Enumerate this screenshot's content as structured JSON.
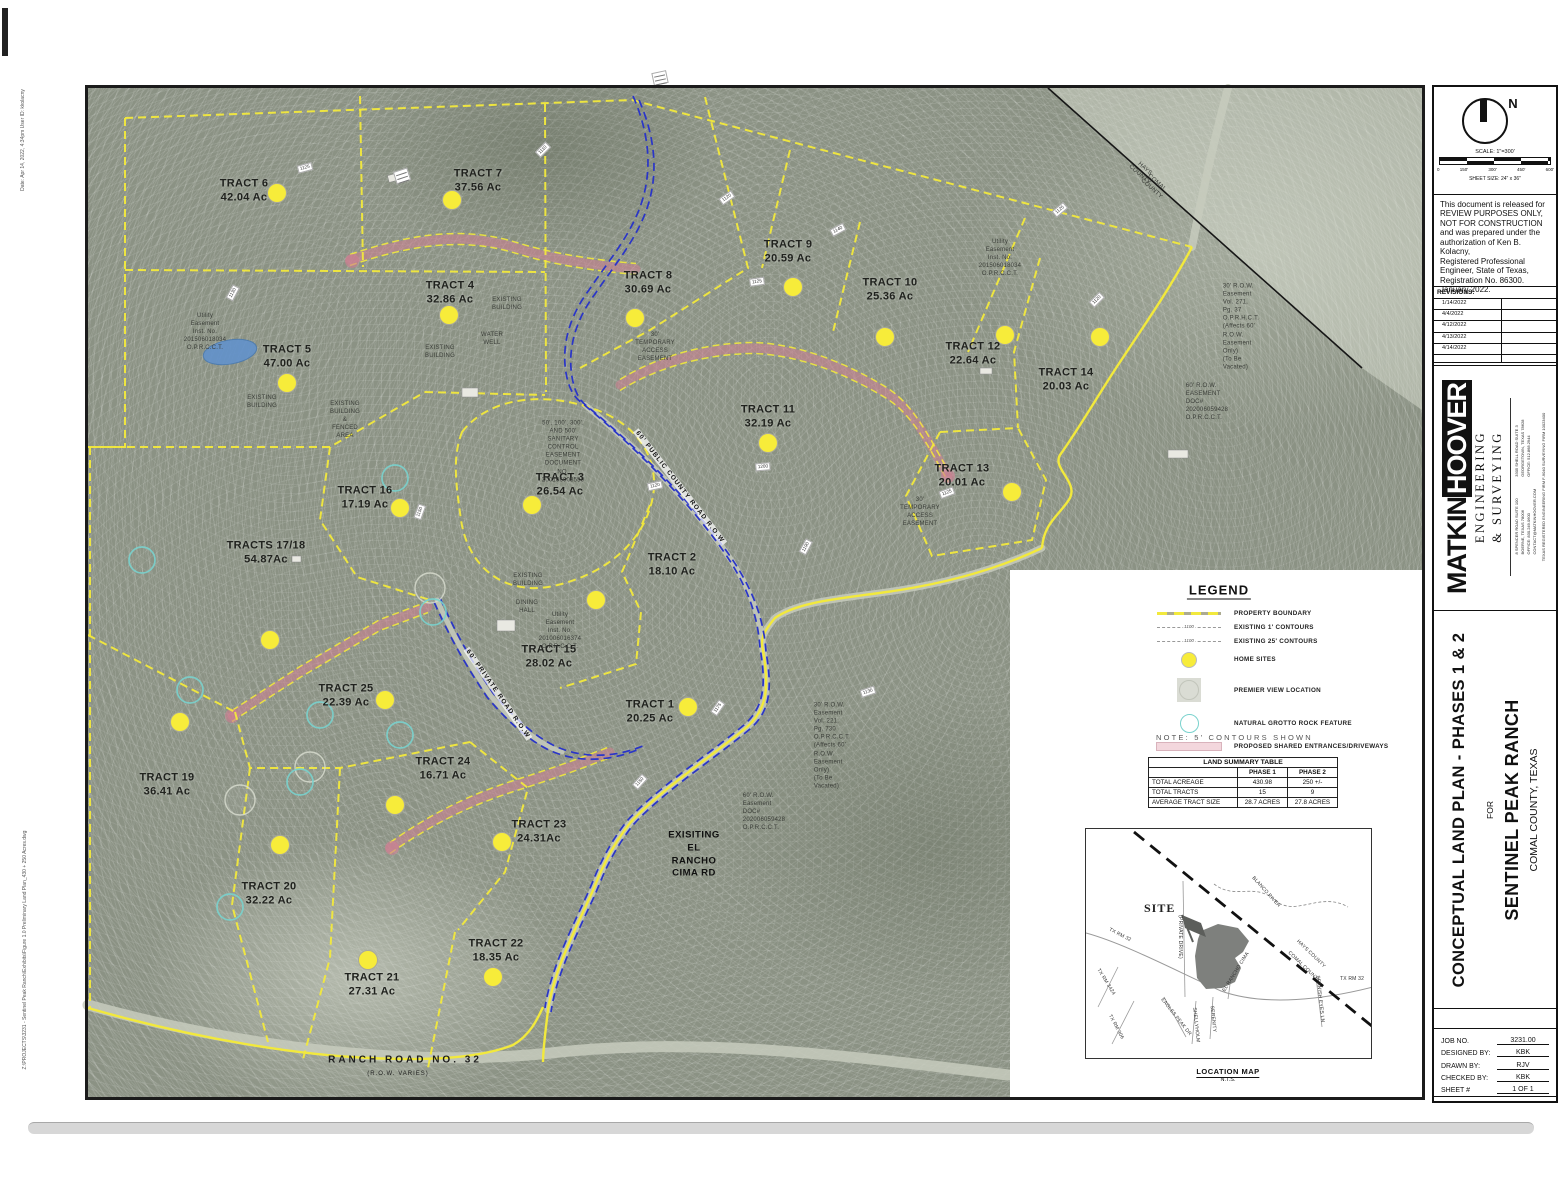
{
  "edge": {
    "date_stamp": "Date: Apr 14, 2022, 4:34pm   User ID: kkolacny",
    "file_path": "Z:\\PROJECTS\\3231 - Sentinel Peak Ranch\\Exhibits\\Figure 1.0 Preliminary Land Plan_430 + 250 Acres.dwg"
  },
  "colors": {
    "boundary_yellow": "#f2e93c",
    "home_site_yellow": "#f7ec3a",
    "road_blue": "#2a35c8",
    "driveway_pink": "#cf7f92",
    "grotto_teal": "#79d2cd",
    "aerial_base": "#8b9284"
  },
  "map": {
    "tracts": [
      {
        "n": "TRACT 6",
        "a": "42.04 Ac",
        "x": 244,
        "y": 191
      },
      {
        "n": "TRACT 7",
        "a": "37.56 Ac",
        "x": 478,
        "y": 181
      },
      {
        "n": "TRACT 4",
        "a": "32.86 Ac",
        "x": 450,
        "y": 293
      },
      {
        "n": "TRACT 5",
        "a": "47.00 Ac",
        "x": 287,
        "y": 357
      },
      {
        "n": "TRACT 8",
        "a": "30.69 Ac",
        "x": 648,
        "y": 283
      },
      {
        "n": "TRACT 9",
        "a": "20.59 Ac",
        "x": 788,
        "y": 252
      },
      {
        "n": "TRACT 10",
        "a": "25.36 Ac",
        "x": 890,
        "y": 290
      },
      {
        "n": "TRACT 12",
        "a": "22.64 Ac",
        "x": 973,
        "y": 354
      },
      {
        "n": "TRACT 14",
        "a": "20.03 Ac",
        "x": 1066,
        "y": 380
      },
      {
        "n": "TRACT 11",
        "a": "32.19 Ac",
        "x": 768,
        "y": 417
      },
      {
        "n": "TRACT 13",
        "a": "20.01 Ac",
        "x": 962,
        "y": 476
      },
      {
        "n": "TRACT 16",
        "a": "17.19 Ac",
        "x": 365,
        "y": 498
      },
      {
        "n": "TRACT 3",
        "a": "26.54 Ac",
        "x": 560,
        "y": 485
      },
      {
        "n": "TRACT 2",
        "a": "18.10 Ac",
        "x": 672,
        "y": 565
      },
      {
        "n": "TRACTS 17/18",
        "a": "54.87Ac",
        "x": 266,
        "y": 553
      },
      {
        "n": "TRACT 15",
        "a": "28.02 Ac",
        "x": 549,
        "y": 657
      },
      {
        "n": "TRACT 25",
        "a": "22.39 Ac",
        "x": 346,
        "y": 696
      },
      {
        "n": "TRACT 19",
        "a": "36.41 Ac",
        "x": 167,
        "y": 785
      },
      {
        "n": "TRACT 24",
        "a": "16.71 Ac",
        "x": 443,
        "y": 769
      },
      {
        "n": "TRACT 1",
        "a": "20.25 Ac",
        "x": 650,
        "y": 712
      },
      {
        "n": "TRACT 23",
        "a": "24.31Ac",
        "x": 539,
        "y": 832
      },
      {
        "n": "TRACT 20",
        "a": "32.22 Ac",
        "x": 269,
        "y": 894
      },
      {
        "n": "TRACT 22",
        "a": "18.35 Ac",
        "x": 496,
        "y": 951
      },
      {
        "n": "TRACT 21",
        "a": "27.31 Ac",
        "x": 372,
        "y": 985
      }
    ],
    "home_sites": [
      [
        277,
        193
      ],
      [
        452,
        200
      ],
      [
        449,
        315
      ],
      [
        287,
        383
      ],
      [
        635,
        318
      ],
      [
        793,
        287
      ],
      [
        885,
        337
      ],
      [
        1005,
        335
      ],
      [
        1100,
        337
      ],
      [
        768,
        443
      ],
      [
        1012,
        492
      ],
      [
        400,
        508
      ],
      [
        532,
        505
      ],
      [
        596,
        600
      ],
      [
        270,
        640
      ],
      [
        385,
        700
      ],
      [
        180,
        722
      ],
      [
        395,
        805
      ],
      [
        688,
        707
      ],
      [
        502,
        842
      ],
      [
        280,
        845
      ],
      [
        493,
        977
      ],
      [
        368,
        960
      ]
    ],
    "grottoes": [
      [
        395,
        478
      ],
      [
        433,
        612
      ],
      [
        400,
        735
      ],
      [
        320,
        715
      ],
      [
        300,
        782
      ],
      [
        230,
        907
      ],
      [
        142,
        560
      ],
      [
        190,
        690
      ]
    ],
    "premier_views": [
      [
        430,
        588
      ],
      [
        240,
        800
      ],
      [
        310,
        767
      ]
    ],
    "elev_tags": [
      {
        "t": "1125",
        "x": 305,
        "y": 168,
        "r": -15
      },
      {
        "t": "1130",
        "x": 233,
        "y": 293,
        "r": -62
      },
      {
        "t": "1110",
        "x": 543,
        "y": 150,
        "r": -45
      },
      {
        "t": "1120",
        "x": 727,
        "y": 198,
        "r": -35
      },
      {
        "t": "1140",
        "x": 838,
        "y": 230,
        "r": -28
      },
      {
        "t": "1125",
        "x": 757,
        "y": 282,
        "r": -8
      },
      {
        "t": "1120",
        "x": 1097,
        "y": 300,
        "r": -45
      },
      {
        "t": "1120",
        "x": 655,
        "y": 486,
        "r": -12
      },
      {
        "t": "1200",
        "x": 763,
        "y": 467,
        "r": -5
      },
      {
        "t": "1150",
        "x": 420,
        "y": 512,
        "r": -70
      },
      {
        "t": "1190",
        "x": 806,
        "y": 547,
        "r": -62
      },
      {
        "t": "1175",
        "x": 718,
        "y": 708,
        "r": -55
      },
      {
        "t": "1150",
        "x": 640,
        "y": 782,
        "r": -48
      },
      {
        "t": "1130",
        "x": 868,
        "y": 692,
        "r": -18
      },
      {
        "t": "1125",
        "x": 947,
        "y": 493,
        "r": -20
      },
      {
        "t": "1125",
        "x": 1060,
        "y": 210,
        "r": -40
      }
    ],
    "stack_tags": [
      [
        402,
        176,
        -18
      ],
      [
        660,
        78,
        -12
      ]
    ],
    "annotations": [
      {
        "t": "Utility Easement\nInst. No. 201506018034\nO.P.R.C.C.T.",
        "x": 205,
        "y": 332
      },
      {
        "t": "EXISTING\nBUILDING",
        "x": 262,
        "y": 402
      },
      {
        "t": "EXISTING BUILDING\n& FENCED AREA",
        "x": 345,
        "y": 420
      },
      {
        "t": "EXISTING\nBUILDING",
        "x": 440,
        "y": 352
      },
      {
        "t": "EXISTING\nBUILDING",
        "x": 507,
        "y": 304
      },
      {
        "t": "WATER WELL",
        "x": 492,
        "y": 339
      },
      {
        "t": "30' TEMPORARY\nACCESS\nEASEMENT",
        "x": 655,
        "y": 347
      },
      {
        "t": "Utility Easement\nInst. No. 201506018034\nO.P.R.C.C.T.",
        "x": 1000,
        "y": 258
      },
      {
        "t": "50', 100', 300', AND 500'\nSANITARY CONTROL EASEMENT\nDOCUMENT NO. 200106008559",
        "x": 563,
        "y": 452
      },
      {
        "t": "EXISTING\nBUILDING",
        "x": 528,
        "y": 580
      },
      {
        "t": "DINING\nHALL",
        "x": 527,
        "y": 607
      },
      {
        "t": "Utility Easement\nInst. No. 201006016374\nO.P.R.C.C.T.",
        "x": 560,
        "y": 631
      },
      {
        "t": "30' R.O.W. Easement\nVol. 271, Pg. 37\nO.P.R.H.C.T.\n(Affects 60' R.O.W. Easement\nOnly)\n(To Be Vacated)",
        "x": 1241,
        "y": 327,
        "cls": "l"
      },
      {
        "t": "60' R.O.W. EASEMENT\nDOC# 202006059428\nO.P.R.C.C.T.",
        "x": 1207,
        "y": 402,
        "cls": "l"
      },
      {
        "t": "30' TEMPORARY\nACCESS\nEASEMENT",
        "x": 920,
        "y": 512
      },
      {
        "t": "30' R.O.W. Easement\nVol. 221, Pg. 730\nO.P.R.C.C.T.\n(Affects 60' R.O.W. Easement\nOnly)\n(To Be Vacated)",
        "x": 832,
        "y": 746,
        "cls": "l"
      },
      {
        "t": "60' R.O.W. Easement\nDOC# 202006059428\nO.P.R.C.C.T.",
        "x": 764,
        "y": 812,
        "cls": "l"
      },
      {
        "t": "EXISITING EL RANCHO\nCIMA RD",
        "x": 694,
        "y": 855,
        "cls": "d"
      },
      {
        "t": "HAYS COUNTY",
        "x": 1142,
        "y": 172,
        "r": 42
      },
      {
        "t": "COMAL COUNTY",
        "x": 1154,
        "y": 186,
        "r": 42
      },
      {
        "t": "RANCH ROAD NO. 32",
        "x": 405,
        "y": 1060,
        "cls": "rr"
      },
      {
        "t": "(R.O.W. VARIES)",
        "x": 398,
        "y": 1074,
        "cls": "rr2"
      }
    ],
    "road_labels": [
      {
        "t": "60' PUBLIC COUNTY ROAD R.O.W",
        "x": 680,
        "y": 487,
        "r": 52
      },
      {
        "t": "60' PRIVATE ROAD R.O.W",
        "x": 498,
        "y": 694,
        "r": 55
      }
    ]
  },
  "legend": {
    "title": "LEGEND",
    "rows": [
      {
        "k": "boundary",
        "label": "PROPERTY BOUNDARY"
      },
      {
        "k": "contour1",
        "label": "EXISTING 1' CONTOURS",
        "tag": "1100"
      },
      {
        "k": "contour25",
        "label": "EXISTING 25' CONTOURS",
        "tag": "1100"
      },
      {
        "k": "home",
        "label": "HOME SITES"
      },
      {
        "k": "premier",
        "label": "PREMIER VIEW LOCATION"
      },
      {
        "k": "grotto",
        "label": "NATURAL GROTTO ROCK FEATURE"
      },
      {
        "k": "driveway",
        "label": "PROPOSED SHARED ENTRANCES/DRIVEWAYS"
      }
    ],
    "note": "NOTE:  5'  CONTOURS  SHOWN"
  },
  "summary": {
    "title": "LAND SUMMARY TABLE",
    "c1": "PHASE 1",
    "c2": "PHASE 2",
    "rows": [
      [
        "TOTAL ACREAGE",
        "430.98",
        "250 +/-"
      ],
      [
        "TOTAL TRACTS",
        "15",
        "9"
      ],
      [
        "AVERAGE TRACT SIZE",
        "28.7 ACRES",
        "27.8 ACRES"
      ]
    ]
  },
  "locmap": {
    "site": "SITE",
    "caption": "LOCATION MAP",
    "nts": "N.T.S.",
    "labels": [
      {
        "t": "TX RM 32",
        "x": 34,
        "y": 106,
        "r": 27
      },
      {
        "t": "TX RM 3424",
        "x": 20,
        "y": 153,
        "r": 58
      },
      {
        "t": "TX RM 306",
        "x": 30,
        "y": 198,
        "r": 62
      },
      {
        "t": "(PRIVATE DRIVE)",
        "x": 94,
        "y": 108,
        "r": 90
      },
      {
        "t": "EAGLES PEAK DR",
        "x": 90,
        "y": 188,
        "r": 52
      },
      {
        "t": "SHELLYHOLM",
        "x": 110,
        "y": 196,
        "r": 84
      },
      {
        "t": "SERENITY",
        "x": 127,
        "y": 190,
        "r": 84
      },
      {
        "t": "EL RANCHO CIMA",
        "x": 150,
        "y": 143,
        "r": -58
      },
      {
        "t": "SPANISH EYES LN",
        "x": 234,
        "y": 170,
        "r": 84
      },
      {
        "t": "BLANCO RIVER",
        "x": 180,
        "y": 63,
        "r": 48
      },
      {
        "t": "HAYS COUNTY",
        "x": 225,
        "y": 125,
        "r": 44
      },
      {
        "t": "COMAL COUNTY",
        "x": 218,
        "y": 138,
        "r": 44
      },
      {
        "t": "TX RM 32",
        "x": 266,
        "y": 150,
        "r": 0
      }
    ]
  },
  "titleblock": {
    "north": "N",
    "scale_label": "SCALE: 1\"=300'",
    "scale_ticks": [
      "0",
      "150'",
      "300'",
      "450'",
      "600'"
    ],
    "sheet_size": "SHEET SIZE: 24\" x 36\"",
    "review_note": "This document is released for\nREVIEW PURPOSES ONLY,\nNOT FOR CONSTRUCTION\nand was prepared under the\nauthorization of Ken B. Kolacny,\nRegistered Professional\nEngineer, State of Texas,\nRegistration No. 86300.\nJanuary 2022.",
    "revisions_label": "REVISIONS:",
    "revisions": [
      "1/14/2022",
      "4/4/2022",
      "4/12/2022",
      "4/13/2022",
      "4/14/2022",
      ""
    ],
    "logo": {
      "name_a": "MATKIN",
      "name_b": "HOOVER",
      "line2": "ENGINEERING",
      "line3": "& SURVEYING",
      "addr_a": "8 SPENCER ROAD SUITE 100\nBOERNE, TEXAS 78006\nOFFICE: 830.249.0600\nCONTACT@MATKINHOOVER.COM",
      "addr_b": "3305 SHELL ROAD SUITE 3\nGEORGETOWN, TEXAS 78628\nOFFICE: 512.868.2944",
      "firm": "TEXAS REGISTERED ENGINEERING FIRM F-9040  SURVEYING FIRM 10023400"
    },
    "title": {
      "line1": "CONCEPTUAL LAND PLAN - PHASES 1 & 2",
      "mid": "FOR",
      "line2": "SENTINEL PEAK RANCH",
      "line3": "COMAL COUNTY, TEXAS"
    },
    "job": [
      {
        "label": "JOB NO.",
        "value": "3231.00"
      },
      {
        "label": "DESIGNED BY:",
        "value": "KBK"
      },
      {
        "label": "DRAWN BY:",
        "value": "RJV"
      },
      {
        "label": "CHECKED BY:",
        "value": "KBK"
      },
      {
        "label": "SHEET #",
        "value": "1 OF 1"
      }
    ]
  }
}
